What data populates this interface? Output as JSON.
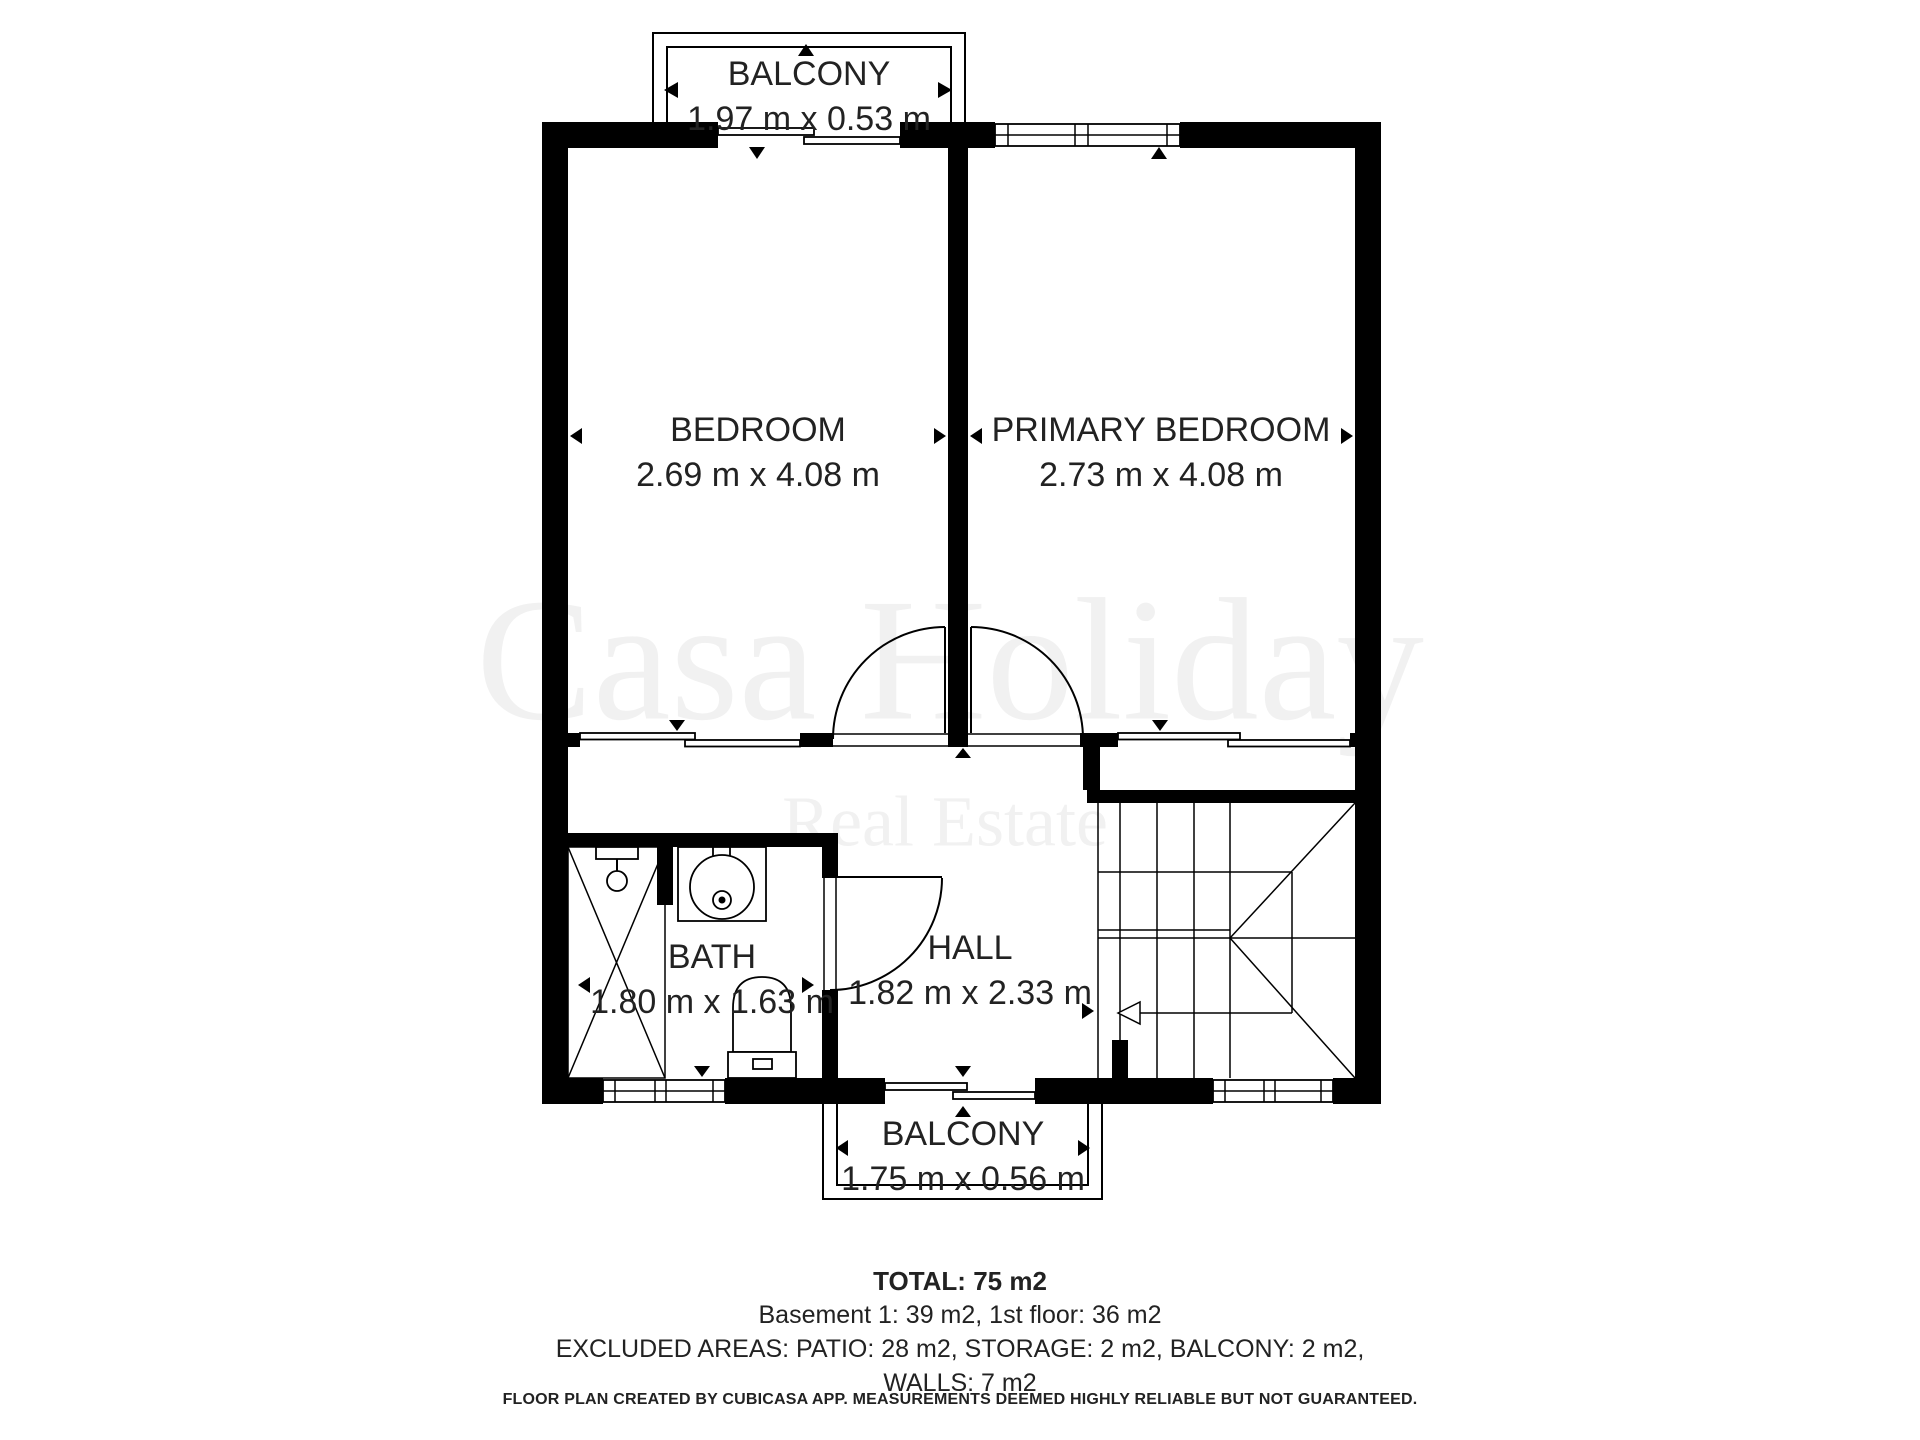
{
  "colors": {
    "background": "#ffffff",
    "walls": "#000000",
    "text": "#222222",
    "watermark": "#f1f1f1"
  },
  "watermark": {
    "line1": "Casa Holiday",
    "line2": "Real Estate"
  },
  "floor_plan": {
    "rooms": [
      {
        "id": "balcony-top",
        "label": "BALCONY",
        "dimensions": "1.97 m x 0.53 m"
      },
      {
        "id": "bedroom",
        "label": "BEDROOM",
        "dimensions": "2.69 m x 4.08 m"
      },
      {
        "id": "primary-bedroom",
        "label": "PRIMARY BEDROOM",
        "dimensions": "2.73 m x 4.08 m"
      },
      {
        "id": "bath",
        "label": "BATH",
        "dimensions": "1.80 m x 1.63 m"
      },
      {
        "id": "hall",
        "label": "HALL",
        "dimensions": "1.82 m x 2.33 m"
      },
      {
        "id": "balcony-bottom",
        "label": "BALCONY",
        "dimensions": "1.75 m x 0.56 m"
      }
    ]
  },
  "summary": {
    "total": "TOTAL: 75 m2",
    "floor_breakdown": "Basement 1: 39 m2, 1st floor: 36 m2",
    "excluded_line1": "EXCLUDED AREAS: PATIO: 28 m2, STORAGE: 2 m2, BALCONY: 2 m2,",
    "excluded_line2": "WALLS: 7 m2"
  },
  "footer": {
    "disclaimer": "FLOOR PLAN CREATED BY CUBICASA APP. MEASUREMENTS DEEMED HIGHLY RELIABLE BUT NOT GUARANTEED."
  }
}
